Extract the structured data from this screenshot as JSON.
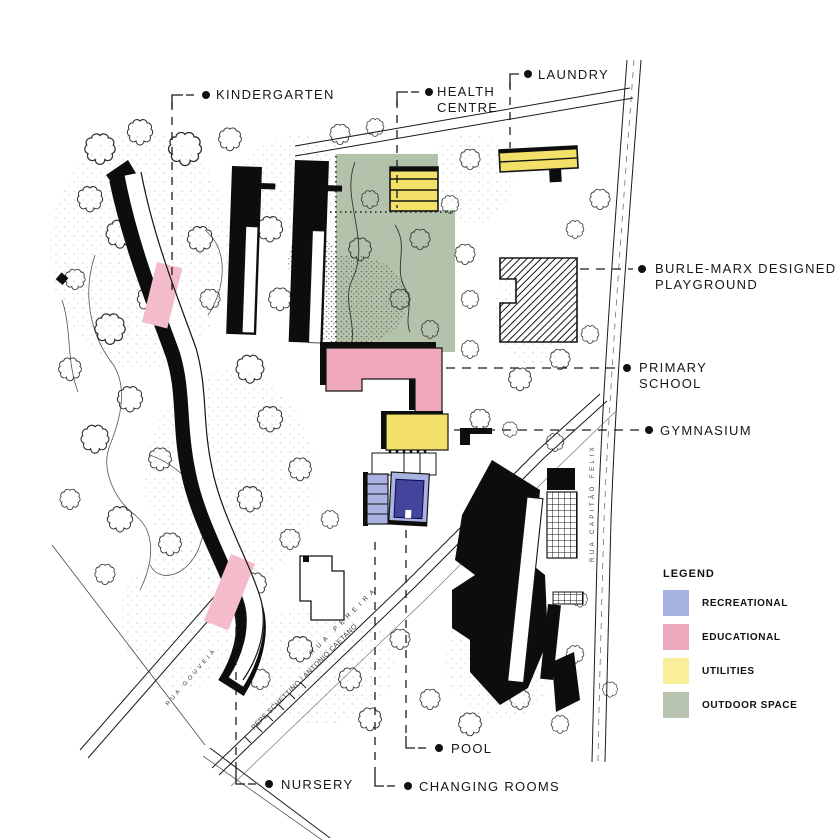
{
  "callouts": {
    "kindergarten": "KINDERGARTEN",
    "health_centre": {
      "line1": "HEALTH",
      "line2": "CENTRE"
    },
    "laundry": "LAUNDRY",
    "burle_marx": {
      "line1": "BURLE-MARX DESIGNED",
      "line2": "PLAYGROUND"
    },
    "primary_school": {
      "line1": "PRIMARY",
      "line2": "SCHOOL"
    },
    "gymnasium": "GYMNASIUM",
    "pool": "POOL",
    "changing_rooms": "CHANGING ROOMS",
    "nursery": "NURSERY"
  },
  "legend": {
    "title": "LEGEND",
    "items": [
      {
        "label": "RECREATIONAL",
        "color": "#a9b3e1"
      },
      {
        "label": "EDUCATIONAL",
        "color": "#eca9bc"
      },
      {
        "label": "UTILITIES",
        "color": "#f9ef9b"
      },
      {
        "label": "OUTDOOR SPACE",
        "color": "#b7c3ae"
      }
    ]
  },
  "streets": {
    "rua_pereira": "RUA PEREIRA",
    "rua_capitao_felix": "RUA CAPITÃO FELIX",
    "rua_gouveia": "RUA GOUVEIA",
    "credit": "PEPE SCHETTINO / ANTONIO CAETANO"
  },
  "colors": {
    "recreational": "#a9b3e1",
    "recreational_dark": "#43459c",
    "educational": "#efa9bb",
    "educational_light": "#f4bcca",
    "utilities": "#f2e068",
    "utilities_pale": "#f9ef9b",
    "outdoor_space": "#b5c2ab",
    "building_black": "#0d0d0d"
  }
}
